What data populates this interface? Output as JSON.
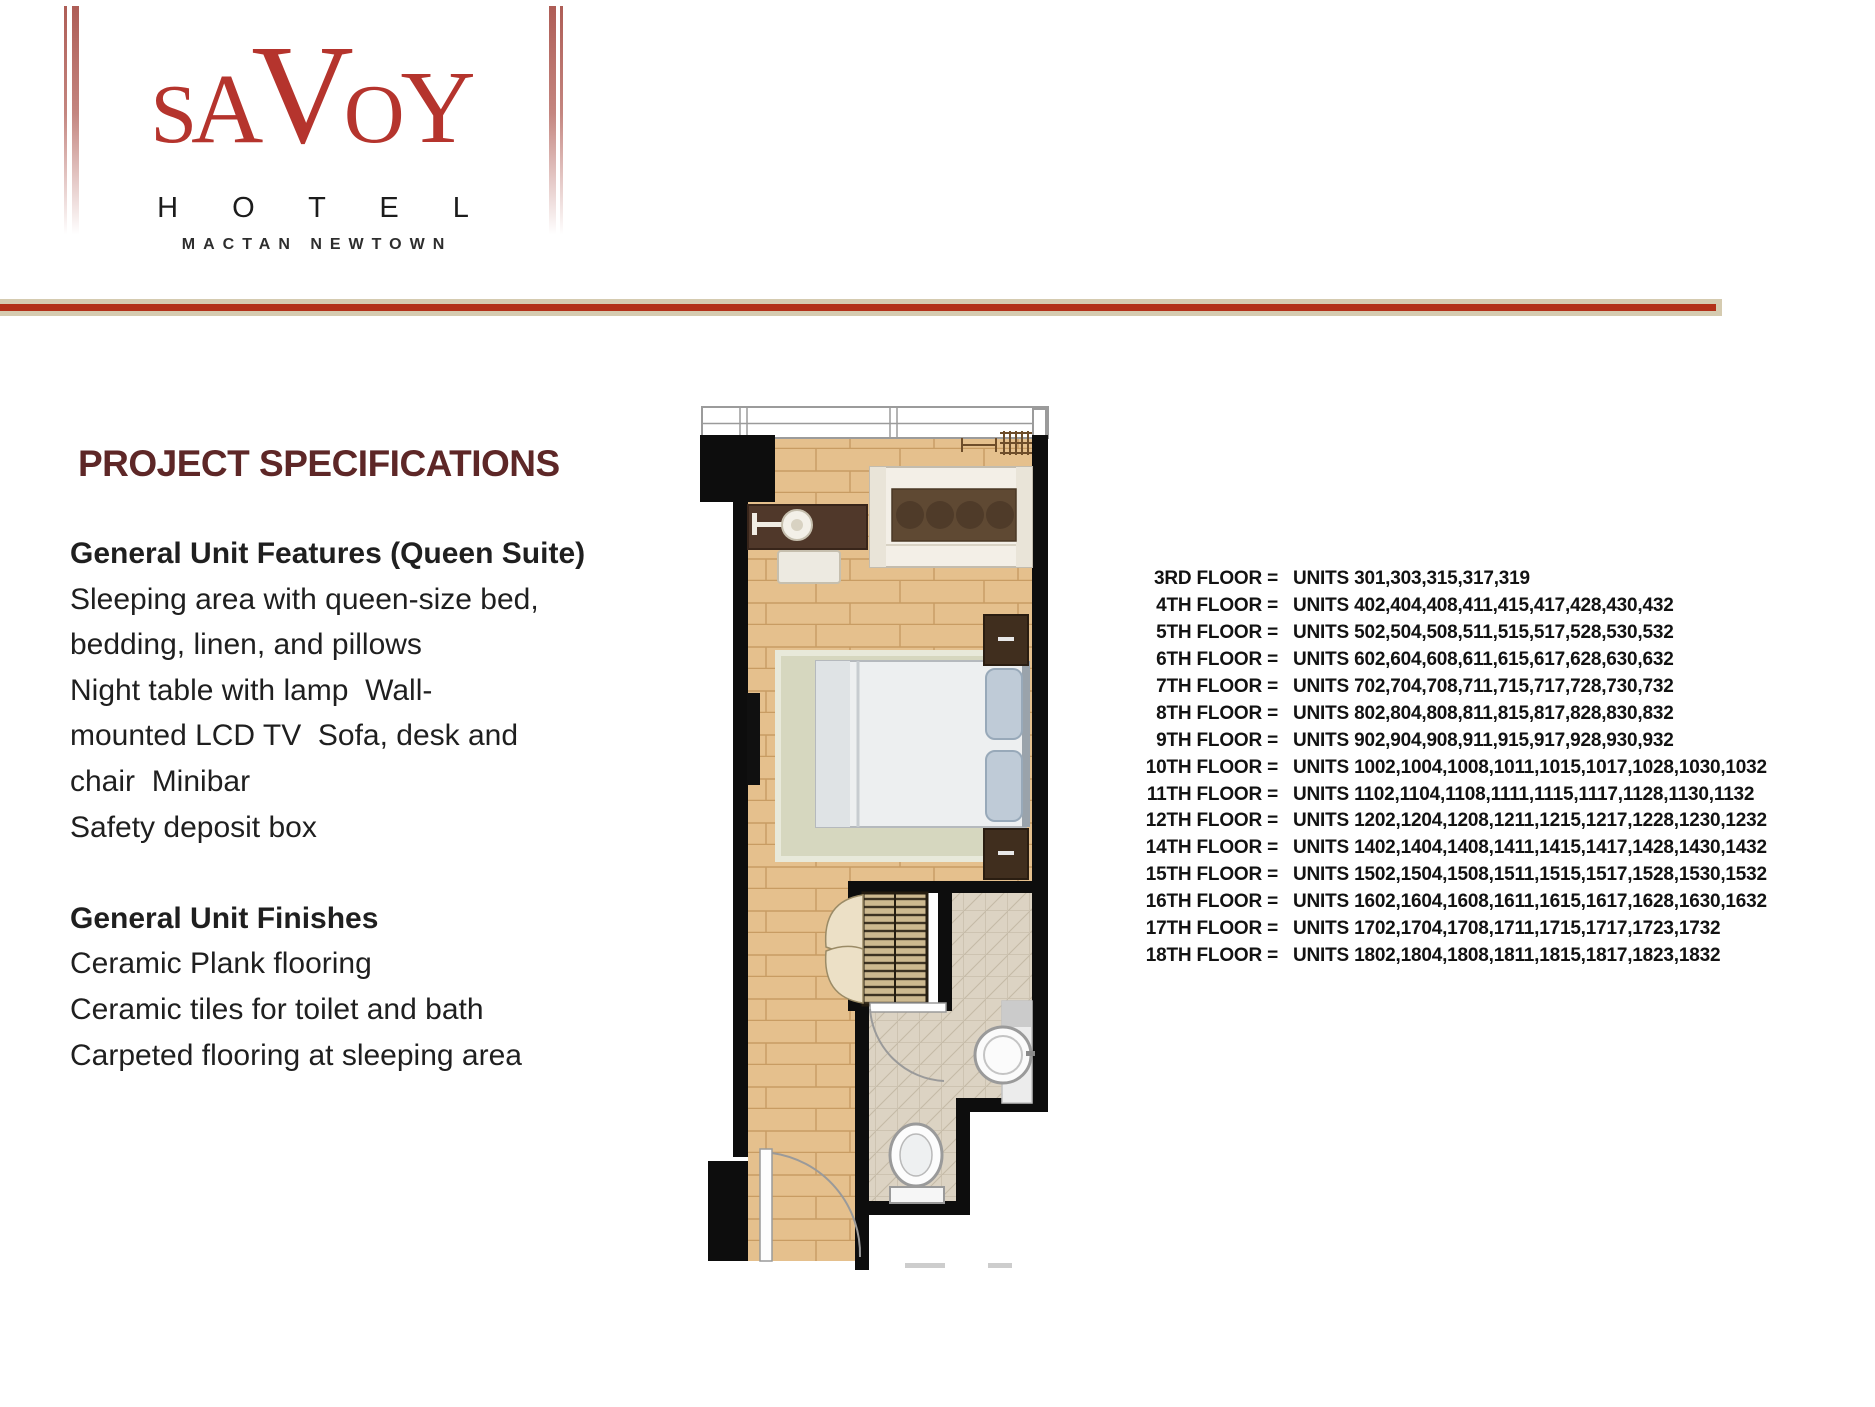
{
  "logo": {
    "letters": [
      "S",
      "A",
      "V",
      "O",
      "Y"
    ],
    "hotel": "H O T E L",
    "location": "MACTAN NEWTOWN"
  },
  "colors": {
    "logo_red": "#b5342d",
    "divider_red": "#b23018",
    "divider_tan": "#d5cbb0",
    "title_maroon": "#5e2727"
  },
  "specs": {
    "title": "PROJECT SPECIFICATIONS",
    "lines": [
      {
        "text": "General Unit Features (Queen Suite)",
        "bold": true
      },
      {
        "text": "Sleeping area with queen-size bed,",
        "bold": false
      },
      {
        "text": "bedding, linen, and pillows",
        "bold": false
      },
      {
        "text": "Night table with lamp  Wall-",
        "bold": false
      },
      {
        "text": "mounted LCD TV  Sofa, desk and",
        "bold": false
      },
      {
        "text": "chair  Minibar",
        "bold": false
      },
      {
        "text": "Safety deposit box",
        "bold": false
      },
      {
        "text": "",
        "bold": false
      },
      {
        "text": "General Unit Finishes",
        "bold": true
      },
      {
        "text": "Ceramic Plank flooring",
        "bold": false
      },
      {
        "text": "Ceramic tiles for toilet and bath",
        "bold": false
      },
      {
        "text": "Carpeted flooring at sleeping area",
        "bold": false
      }
    ]
  },
  "floor_plan": {
    "description": "Queen Suite unit floor plan"
  },
  "floors": {
    "rows": [
      {
        "label": "3RD FLOOR =",
        "units": "UNITS 301,303,315,317,319"
      },
      {
        "label": "4TH FLOOR =",
        "units": "UNITS 402,404,408,411,415,417,428,430,432"
      },
      {
        "label": "5TH FLOOR =",
        "units": "UNITS 502,504,508,511,515,517,528,530,532"
      },
      {
        "label": "6TH FLOOR =",
        "units": "UNITS 602,604,608,611,615,617,628,630,632"
      },
      {
        "label": "7TH FLOOR =",
        "units": "UNITS 702,704,708,711,715,717,728,730,732"
      },
      {
        "label": "8TH FLOOR =",
        "units": "UNITS 802,804,808,811,815,817,828,830,832"
      },
      {
        "label": "9TH FLOOR =",
        "units": "UNITS 902,904,908,911,915,917,928,930,932"
      },
      {
        "label": "10TH FLOOR =",
        "units": "UNITS 1002,1004,1008,1011,1015,1017,1028,1030,1032"
      },
      {
        "label": "11TH FLOOR =",
        "units": "UNITS 1102,1104,1108,1111,1115,1117,1128,1130,1132"
      },
      {
        "label": "12TH FLOOR =",
        "units": "UNITS 1202,1204,1208,1211,1215,1217,1228,1230,1232"
      },
      {
        "label": "14TH FLOOR =",
        "units": "UNITS 1402,1404,1408,1411,1415,1417,1428,1430,1432"
      },
      {
        "label": "15TH FLOOR =",
        "units": "UNITS 1502,1504,1508,1511,1515,1517,1528,1530,1532"
      },
      {
        "label": "16TH FLOOR =",
        "units": "UNITS 1602,1604,1608,1611,1615,1617,1628,1630,1632"
      },
      {
        "label": "17TH FLOOR =",
        "units": "UNITS 1702,1704,1708,1711,1715,1717,1723,1732"
      },
      {
        "label": "18TH FLOOR =",
        "units": "UNITS 1802,1804,1808,1811,1815,1817,1823,1832"
      }
    ]
  }
}
